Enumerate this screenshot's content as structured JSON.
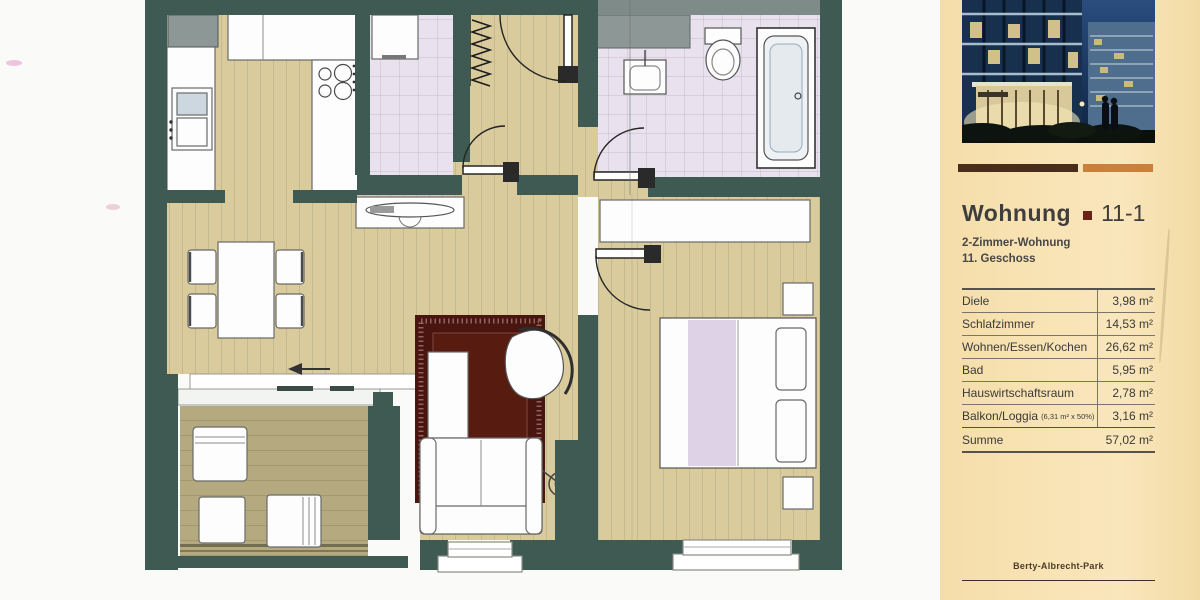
{
  "colors": {
    "wall": "#3e5a52",
    "shaft": "#8d9796",
    "floor-wood": "#d9cb9c",
    "floor-deck": "#b5aa7f",
    "floor-tile": "#e9e2ee",
    "rug": "#4a150e",
    "panel-bg": "#f8e2b2",
    "bar-dark": "#4a2c1a",
    "bar-orange": "#c9803a",
    "accent-square": "#6b2018",
    "ink": "#3b3b3b"
  },
  "panel": {
    "title": "Wohnung",
    "unit": "11-1",
    "subtitle1": "2-Zimmer-Wohnung",
    "subtitle2": "11. Geschoss",
    "footer": "Berty-Albrecht-Park",
    "table": {
      "rows": [
        {
          "label": "Diele",
          "value": "3,98 m²"
        },
        {
          "label": "Schlafzimmer",
          "value": "14,53 m²"
        },
        {
          "label": "Wohnen/Essen/Kochen",
          "value": "26,62 m²"
        },
        {
          "label": "Bad",
          "value": "5,95 m²"
        },
        {
          "label": "Hauswirtschaftsraum",
          "value": "2,78 m²"
        },
        {
          "label": "Balkon/Loggia",
          "label_note": "(6,31 m² x 50%)",
          "value": "3,16 m²"
        },
        {
          "label": "Summe",
          "value": "57,02 m²"
        }
      ]
    }
  }
}
